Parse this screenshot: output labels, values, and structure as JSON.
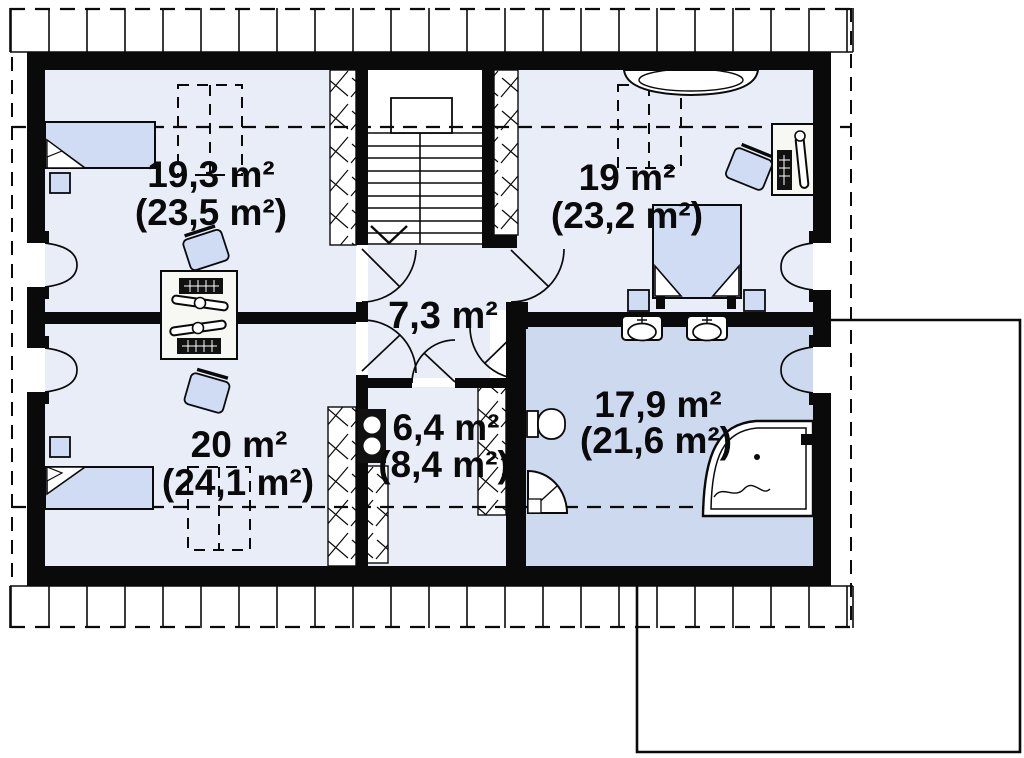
{
  "floor_plan": {
    "type": "attic-storey-floor-plan",
    "rooms": [
      {
        "id": "bedroom-top-left",
        "area": "19,3 m²",
        "area_with_slopes": "(23,5 m²)"
      },
      {
        "id": "bedroom-top-right",
        "area": "19 m²",
        "area_with_slopes": "(23,2 m²)"
      },
      {
        "id": "hall",
        "area": "7,3 m²",
        "area_with_slopes": ""
      },
      {
        "id": "bedroom-bottom-left",
        "area": "20 m²",
        "area_with_slopes": "(24,1 m²)"
      },
      {
        "id": "utility-room",
        "area": "6,4 m²",
        "area_with_slopes": "(8,4 m²)"
      },
      {
        "id": "bathroom",
        "area": "17,9 m²",
        "area_with_slopes": "(21,6 m²)"
      }
    ],
    "colors": {
      "wall": "#0a0a0a",
      "room_floor": "#e8edf8",
      "bathroom_floor": "#ccd9ee",
      "furniture_fill": "#cfdcf3",
      "background": "#ffffff",
      "line": "#000000"
    }
  }
}
